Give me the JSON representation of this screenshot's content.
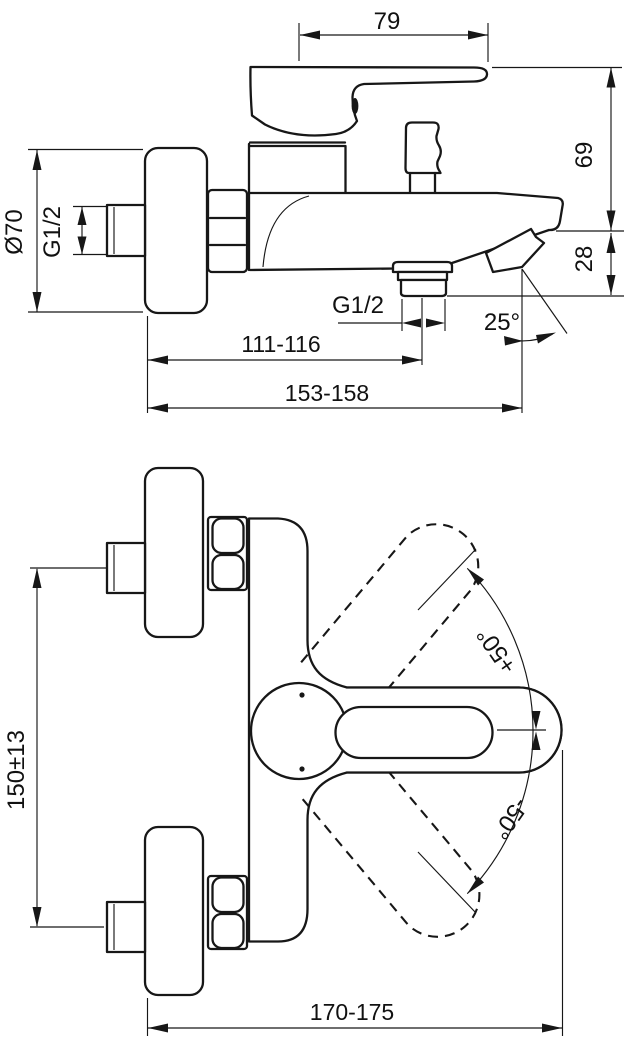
{
  "front_view": {
    "handle_length": "79",
    "upper_height": "69",
    "spout_height": "28",
    "flange_diameter": "Ø70",
    "inlet_thread": "G1/2",
    "hose_outlet_thread": "G1/2",
    "outlet_angle": "25°",
    "wall_to_outlet_center": "111-116",
    "overall_depth": "153-158"
  },
  "plan_view": {
    "connection_centres": "150±13",
    "handle_swing_up": "+50°",
    "handle_swing_down": "-50°",
    "overall_width": "170-175"
  }
}
